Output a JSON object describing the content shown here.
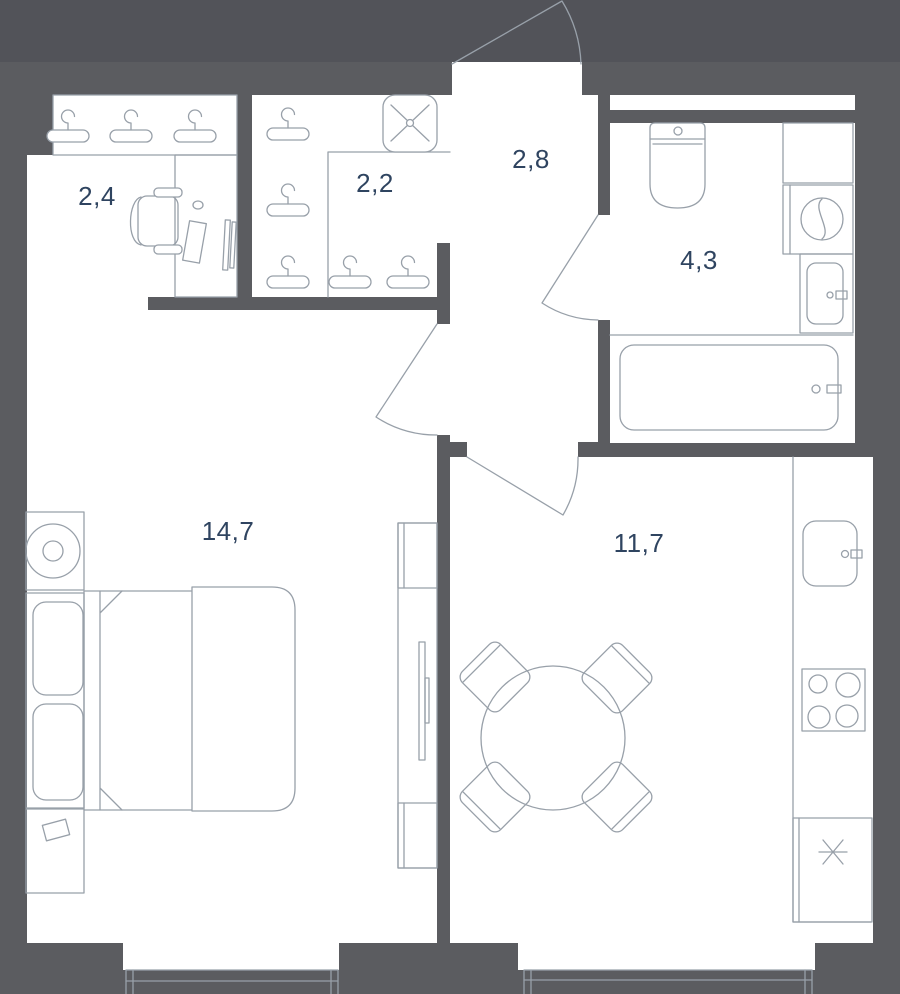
{
  "colors": {
    "wall": "#5b5c60",
    "outside": "#525359",
    "floor": "#ffffff",
    "line": "#98a0a9",
    "label": "#2f4460"
  },
  "rooms": [
    {
      "id": "wardrobe",
      "area": "2,4",
      "furniture": [
        "hanger-rail-3",
        "desk",
        "office-chair"
      ]
    },
    {
      "id": "hall-closet",
      "area": "2,2",
      "furniture": [
        "hanger-rail-5",
        "ceiling-fan"
      ]
    },
    {
      "id": "entry-hall",
      "area": "2,8",
      "furniture": []
    },
    {
      "id": "bathroom",
      "area": "4,3",
      "furniture": [
        "toilet",
        "cabinet",
        "washing-machine",
        "sink",
        "bathtub"
      ]
    },
    {
      "id": "bedroom",
      "area": "14,7",
      "furniture": [
        "nightstand-lamp",
        "double-bed",
        "pillows",
        "nightstand",
        "tv-unit"
      ]
    },
    {
      "id": "kitchen-living",
      "area": "11,7",
      "furniture": [
        "round-dining-table",
        "chairs-4",
        "kitchen-counter",
        "sink",
        "stove",
        "fridge"
      ]
    }
  ],
  "doors": [
    "entry-door",
    "bedroom-door",
    "kitchen-door",
    "bathroom-door"
  ],
  "windows": [
    "bedroom-window",
    "kitchen-window"
  ]
}
